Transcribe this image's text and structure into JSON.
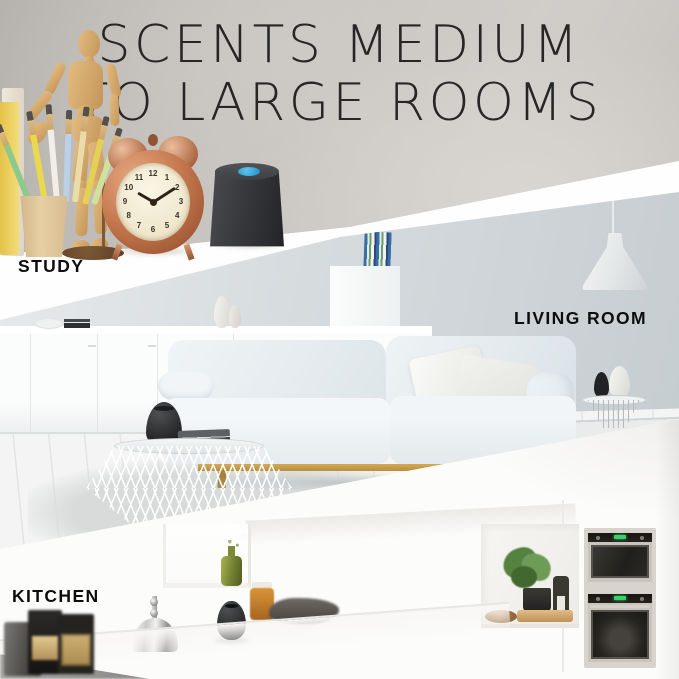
{
  "image_type": "product lifestyle collage",
  "title": {
    "line1": "SCENTS MEDIUM",
    "line2": "TO LARGE ROOMS"
  },
  "rooms": {
    "study": {
      "label": "STUDY"
    },
    "living_room": {
      "label": "LIVING ROOM"
    },
    "kitchen": {
      "label": "KITCHEN"
    }
  },
  "clock": {
    "time_shown": "10:09",
    "numerals": [
      "12",
      "1",
      "2",
      "3",
      "4",
      "5",
      "6",
      "7",
      "8",
      "9",
      "10",
      "11"
    ]
  },
  "product": {
    "type": "aroma-diffuser",
    "body_color": "#2e2f31",
    "button_color": "#2aa3d8",
    "instances_visible": 3
  },
  "colors": {
    "title_text": "#262626",
    "label_text": "#0d0d0d",
    "study_wall": "#c7c3bf",
    "living_wall": "#ccd2d5",
    "kitchen_bg": "#fbfbfa",
    "divider_band": "#ffffff",
    "clock_copper": "#b97a52",
    "sofa_fabric": "#e9eef1",
    "sofa_leg_gold": "#c2a04e"
  }
}
